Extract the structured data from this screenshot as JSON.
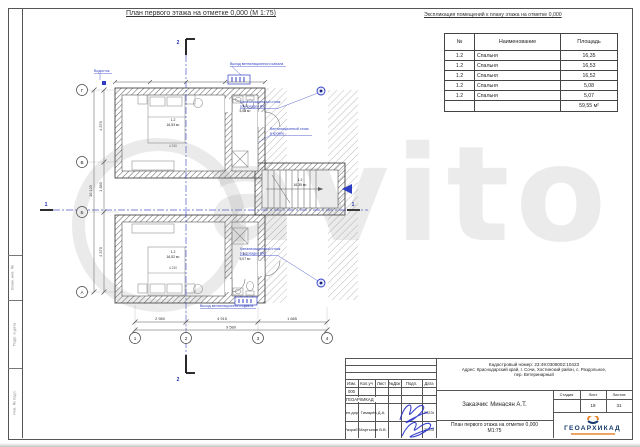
{
  "sheet": {
    "plan_title": "План первого этажа на отметке 0,000 (М 1:75)",
    "table_title": "Экспликация помещений к плану этажа  на отметке 0,000"
  },
  "room_table": {
    "headers": [
      "№",
      "Наименование",
      "Площадь"
    ],
    "rows": [
      [
        "1.2",
        "Спальня",
        "16,35"
      ],
      [
        "1.2",
        "Спальня",
        "16,53"
      ],
      [
        "1.2",
        "Спальня",
        "16,52"
      ],
      [
        "1.2",
        "Спальня",
        "5,08"
      ],
      [
        "1.2",
        "Спальня",
        "5,07"
      ]
    ],
    "total": "59,55 м²"
  },
  "plan": {
    "axes_bottom": [
      "1",
      "2",
      "3",
      "4"
    ],
    "axes_left": [
      "Г",
      "В",
      "Б",
      "А"
    ],
    "section_marks": [
      "1",
      "2"
    ],
    "dims_bottom": [
      "2 980",
      "4 915",
      "1 685"
    ],
    "dim_total_bottom": "9 580",
    "dims_left": [
      "4 370",
      "1 380",
      "4 370"
    ],
    "dim_total_left": "10 120",
    "interior_dim": "4 230",
    "rooms": [
      {
        "num": "1.2",
        "area": "16,53 м²"
      },
      {
        "num": "1.2",
        "area": "5,08 м²"
      },
      {
        "num": "1.2",
        "area": "16,35 м²"
      },
      {
        "num": "1.2",
        "area": "16,52 м²"
      },
      {
        "num": "1.2",
        "area": "5,07 м²"
      }
    ],
    "annotations": {
      "downspout": "Водосток",
      "vent_exit": "Выход вентиляционного канала",
      "sewer_l1": "Канализационный стояк",
      "sewer_l2": "(см. раздел ВК)",
      "vent_riser_l1": "Вентиляционный стояк",
      "vent_riser_l2": "в кровле"
    }
  },
  "watermark": {
    "text": "avito"
  },
  "frame": {
    "stamps": [
      "Взам. инв. №",
      "Подп. и дата",
      "Инв. № подл."
    ]
  },
  "title_block": {
    "cadastre": "Кадастровый номер: 23:49:0308002:10423",
    "address_line1": "Адрес: Краснодарский край, г. Сочи, Хостинский район, с. Раздольное,",
    "address_line2": "пер. Ветеринарный",
    "header_cells": [
      "Изм.",
      "Кол.уч",
      "Лист",
      "№Док",
      "Подп.",
      "Дата"
    ],
    "doc_number": "000",
    "org": "ГЕОАРХИКАД",
    "row_gendir": {
      "role": "Ген.дир.",
      "name": "Тимарёв Д.А.",
      "date": "2023г"
    },
    "row_razrab": {
      "role": "Разраб.",
      "name": "Мартынов В.В.",
      "date": "2023г"
    },
    "client": "Заказчик: Минасян А.Т.",
    "sheet_title_line1": "План первого этажа на отметке 0,000",
    "sheet_title_line2": "М1:75",
    "stage_headers": [
      "Стадия",
      "Лист",
      "Листов"
    ],
    "stage_values": [
      "",
      "19",
      "31"
    ],
    "logo_text": "ГЕОАРХИКАД"
  }
}
